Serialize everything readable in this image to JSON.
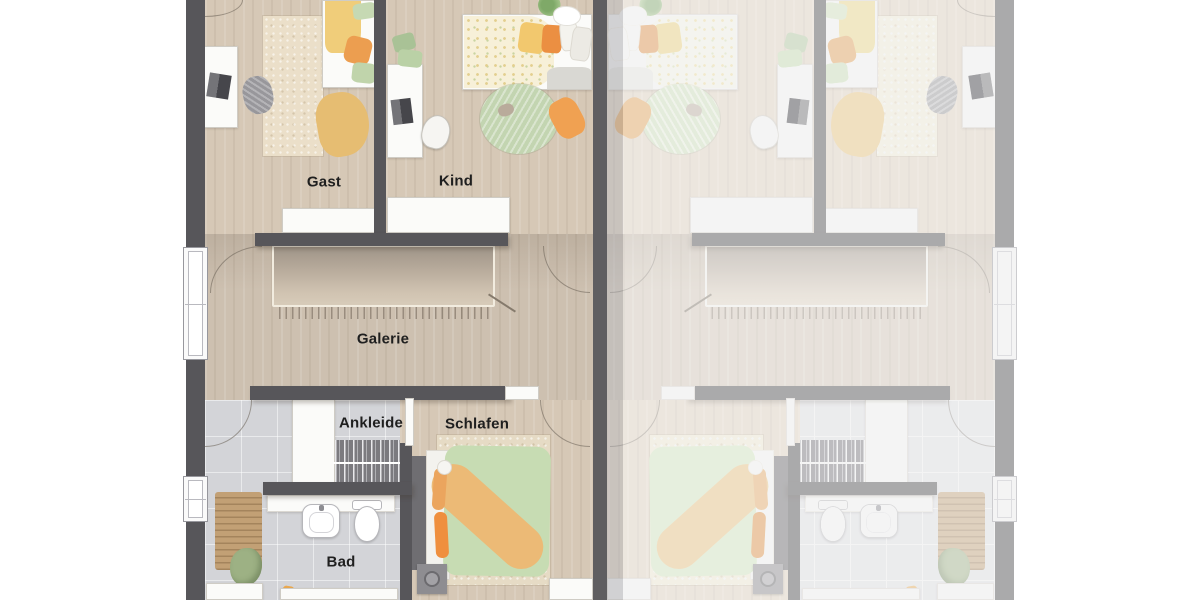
{
  "floorplan": {
    "rooms": {
      "gast": "Gast",
      "kind": "Kind",
      "galerie": "Galerie",
      "ankleide": "Ankleide",
      "schlafen": "Schlafen",
      "bad": "Bad"
    },
    "colors": {
      "wall": "#57565a",
      "faded_wall": "#b2b2b6",
      "wood_floor": "#d6c8b6",
      "hall_floor": "#cdc0b0",
      "tile_floor": "#d3d4d8",
      "rug_cream": "#ebdfc9",
      "accent_green": "#c6d9b3",
      "accent_yellow": "#f0cd7a",
      "accent_orange": "#ec9e50"
    }
  }
}
